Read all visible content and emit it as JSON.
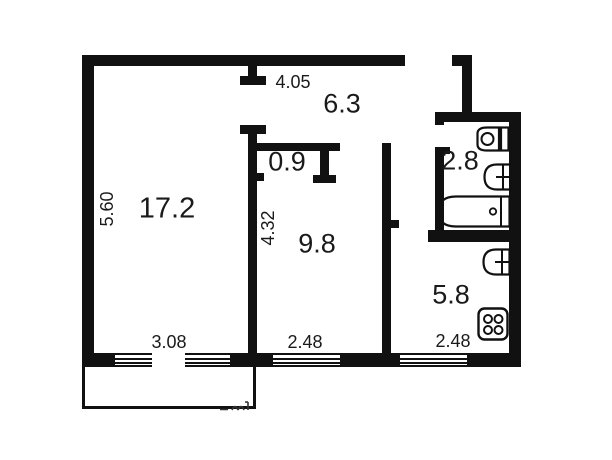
{
  "title": "apartment floor plan",
  "colors": {
    "wall": "#111111",
    "background": "#ffffff",
    "text": "#1a1a1a"
  },
  "rooms": {
    "living": {
      "area": "17.2"
    },
    "hallway": {
      "area": "6.3"
    },
    "closet": {
      "area": "0.9"
    },
    "bedroom": {
      "area": "9.8"
    },
    "bathroom": {
      "area": "2.8"
    },
    "kitchen": {
      "area": "5.8"
    }
  },
  "dimensions": {
    "hallway_width": "4.05",
    "living_height": "5.60",
    "bedroom_height": "4.32",
    "living_width": "3.08",
    "bedroom_width": "2.48",
    "kitchen_width": "2.48"
  },
  "fixtures": [
    "toilet",
    "sink",
    "bathtub",
    "kitchen-sink",
    "stove"
  ]
}
